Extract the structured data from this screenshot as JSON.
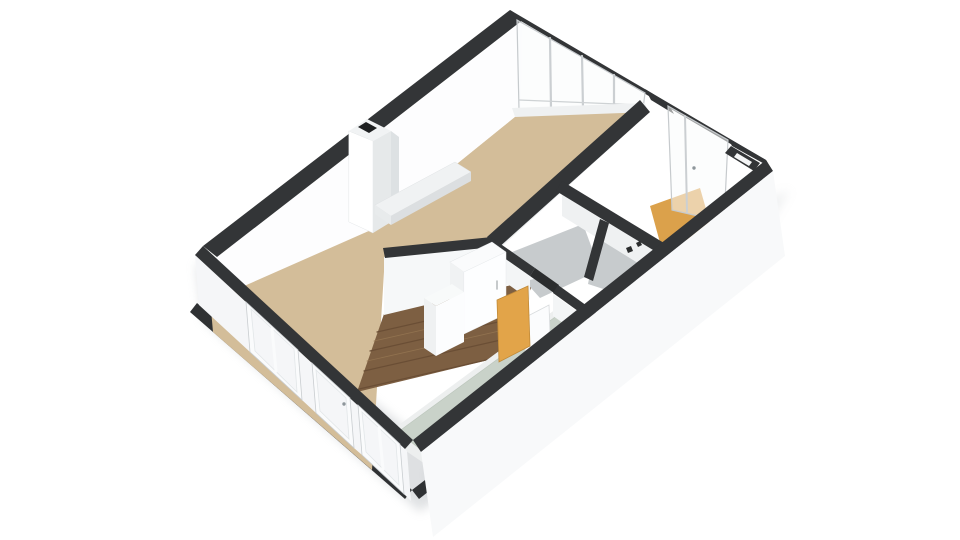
{
  "canvas": {
    "width": 960,
    "height": 540,
    "background": "#ffffff"
  },
  "palette": {
    "wall_top_dark": "#333537",
    "wall_face_white": "#fdfdfe",
    "floor_living_tan": "#d3bd99",
    "floor_hall_wood": "#7d5f42",
    "floor_bath_sage": "#c9d2c9",
    "floor_storage_gray": "#c7cbcd",
    "floor_balcony_orange": "#dba14b",
    "door_orange": "#e2a449",
    "frame_gray": "#c9cdd0",
    "slab_edge_dark": "#2f3133"
  },
  "scene": {
    "shapes": [
      {
        "name": "ground-shadow-sw",
        "type": "polygon",
        "points": "196,262 203,320 420,512 478,466 435,450",
        "fill": "#aab0b5",
        "opacity": 0.38,
        "blur": true
      },
      {
        "name": "ground-shadow-se",
        "type": "polygon",
        "points": "430,500 760,240 790,190 740,210 425,470",
        "fill": "#b6bbbf",
        "opacity": 0.22,
        "blur": true
      },
      {
        "name": "floor-slab-edge-sw",
        "type": "polygon",
        "points": "197,303 412,490 405,499 190,312",
        "fill": "#2f3133"
      },
      {
        "name": "floor-slab-edge-corner",
        "type": "polygon",
        "points": "412,490 468,447 475,455 419,499",
        "fill": "#2f3133"
      },
      {
        "name": "living-room-floor",
        "type": "polygon",
        "points": "210,298 380,226 521,112 640,112 488,246 385,255 372,470 213,332",
        "fill": "#d3bd99"
      },
      {
        "name": "hallway-wood-floor",
        "type": "polygon",
        "points": "357,392 384,314 534,280 505,356",
        "fill": "#7d5f42"
      },
      {
        "name": "wood-plank-line-1",
        "type": "line",
        "x1": 377,
        "y1": 332,
        "x2": 527,
        "y2": 298,
        "stroke": "#6a4e35",
        "stroke_width": 1.2
      },
      {
        "name": "wood-plank-line-2",
        "type": "line",
        "x1": 370,
        "y1": 351,
        "x2": 520,
        "y2": 317,
        "stroke": "#6a4e35",
        "stroke_width": 1.2
      },
      {
        "name": "wood-plank-line-3",
        "type": "line",
        "x1": 364,
        "y1": 371,
        "x2": 514,
        "y2": 337,
        "stroke": "#6a4e35",
        "stroke_width": 1.2
      },
      {
        "name": "wood-plank-line-4",
        "type": "line",
        "x1": 359,
        "y1": 389,
        "x2": 508,
        "y2": 355,
        "stroke": "#6a4e35",
        "stroke_width": 1.2
      },
      {
        "name": "wood-plank-highlight-1",
        "type": "line",
        "x1": 374,
        "y1": 341,
        "x2": 524,
        "y2": 307,
        "stroke": "#91724f",
        "stroke_width": 0.8
      },
      {
        "name": "wood-plank-highlight-2",
        "type": "line",
        "x1": 367,
        "y1": 361,
        "x2": 517,
        "y2": 327,
        "stroke": "#91724f",
        "stroke_width": 0.8
      },
      {
        "name": "bathroom-floor-border",
        "type": "polygon",
        "points": "384,436 560,306 604,338 434,470",
        "fill": "#edefef"
      },
      {
        "name": "bathroom-floor-sage",
        "type": "polygon",
        "points": "398,432 558,315 590,338 428,455",
        "fill": "#c9d2c9",
        "stroke": "#bdc7bd",
        "stroke_width": 0.75
      },
      {
        "name": "storage-room-floor-1",
        "type": "polygon",
        "points": "502,256 583,224 600,270 540,298",
        "fill": "#c7cbcd"
      },
      {
        "name": "storage-room-floor-2",
        "type": "polygon",
        "points": "598,232 655,252 637,300 588,284",
        "fill": "#c7cbcd"
      },
      {
        "name": "balcony-room-floor-orange",
        "type": "polygon",
        "points": "650,206 700,188 712,230 662,250",
        "fill": "#dba14b"
      },
      {
        "name": "nw-wall-inner-face",
        "type": "polygon",
        "points": "216,258 522,22 521,112 380,226 226,294",
        "fill": "#fdfdfe"
      },
      {
        "name": "nw-wall-top-band",
        "type": "polygon",
        "points": "203,246 510,10 524,19 217,257",
        "fill": "#333537"
      },
      {
        "name": "chimney-left-face",
        "type": "polygon",
        "points": "349,131 373,141 373,233 349,222",
        "fill": "#ffffff",
        "stroke": "#e4e7e9",
        "stroke_width": 0.5
      },
      {
        "name": "chimney-right-face",
        "type": "polygon",
        "points": "373,141 391,131 391,222 373,233",
        "fill": "#e6e9ea"
      },
      {
        "name": "chimney-flue-facet",
        "type": "polygon",
        "points": "391,131 399,137 399,214 391,222",
        "fill": "#dde1e3"
      },
      {
        "name": "chimney-top-face",
        "type": "polygon",
        "points": "349,131 367,119 391,131 373,141",
        "fill": "#f1f3f4"
      },
      {
        "name": "chimney-flue-slot",
        "type": "polygon",
        "points": "358,127 366,122 377,128 369,133",
        "fill": "#1e2021"
      },
      {
        "name": "hearth-top",
        "type": "polygon",
        "points": "375,205 455,162 471,172 391,216",
        "fill": "#f0f2f3",
        "stroke": "#dfe2e4",
        "stroke_width": 0.5
      },
      {
        "name": "hearth-front-face",
        "type": "polygon",
        "points": "391,216 471,172 471,181 391,225",
        "fill": "#dcdfe1"
      },
      {
        "name": "hearth-side-face",
        "type": "polygon",
        "points": "375,205 391,216 391,225 375,214",
        "fill": "#e8ebec"
      },
      {
        "name": "ne-wall-top-band",
        "type": "polygon",
        "points": "510,10 766,160 770,167 514,17",
        "fill": "#333537"
      },
      {
        "name": "ne-window-glass",
        "type": "polygon",
        "points": "517,20 645,93 643,109 519,110",
        "fill": "rgba(250,251,252,0.5)",
        "stroke": "#c6cacd",
        "stroke_width": 1.2
      },
      {
        "name": "ne-window-mullion-1",
        "type": "line",
        "x1": 550,
        "y1": 38,
        "x2": 551,
        "y2": 109,
        "stroke": "#cbcfd2",
        "stroke_width": 2.2
      },
      {
        "name": "ne-window-mullion-2",
        "type": "line",
        "x1": 582,
        "y1": 56,
        "x2": 583,
        "y2": 109,
        "stroke": "#cbcfd2",
        "stroke_width": 2.2
      },
      {
        "name": "ne-window-mullion-3",
        "type": "line",
        "x1": 614,
        "y1": 75,
        "x2": 614,
        "y2": 108,
        "stroke": "#cbcfd2",
        "stroke_width": 2.2
      },
      {
        "name": "ne-window-transom",
        "type": "line",
        "x1": 519,
        "y1": 100,
        "x2": 643,
        "y2": 105,
        "stroke": "#ced2d4",
        "stroke_width": 1.2
      },
      {
        "name": "ne-window-sill",
        "type": "polygon",
        "points": "512,108 645,103 648,112 515,117",
        "fill": "#eff1f2"
      },
      {
        "name": "ne-wall-pier-band",
        "type": "polygon",
        "points": "645,89 668,103 674,114 651,100",
        "fill": "#333537"
      },
      {
        "name": "balcony-door-glass",
        "type": "polygon",
        "points": "668,106 728,140 724,222 672,210",
        "fill": "rgba(250,251,252,0.55)",
        "stroke": "#c6cacd",
        "stroke_width": 1.2
      },
      {
        "name": "balcony-door-divider",
        "type": "line",
        "x1": 685,
        "y1": 116,
        "x2": 687,
        "y2": 212,
        "stroke": "#cbcfd2",
        "stroke_width": 2
      },
      {
        "name": "balcony-door-handle",
        "type": "circle",
        "cx": 694,
        "cy": 168,
        "r": 1.7,
        "fill": "#8e969b"
      },
      {
        "name": "ne-wall-right-band",
        "type": "polygon",
        "points": "728,138 766,160 770,167 732,146",
        "fill": "#333537"
      },
      {
        "name": "corner-pillar-dark",
        "type": "polygon",
        "points": "731,146 760,163 754,171 725,153",
        "fill": "#333537"
      },
      {
        "name": "corner-pillar-notch",
        "type": "polygon",
        "points": "737,153 752,162 749,166 734,157",
        "fill": "#f4f5f6"
      },
      {
        "name": "wall-b-face",
        "type": "polygon",
        "points": "490,244 643,107 643,118 496,252",
        "fill": "#eef0f1"
      },
      {
        "name": "wall-b-top-band",
        "type": "polygon",
        "points": "640,100 650,112 497,249 487,237",
        "fill": "#333537"
      },
      {
        "name": "wall-e-face",
        "type": "polygon",
        "points": "562,190 662,252 662,278 562,216",
        "fill": "#eff1f2"
      },
      {
        "name": "wall-e-top-band",
        "type": "polygon",
        "points": "562,181 664,243 658,253 556,191",
        "fill": "#333537"
      },
      {
        "name": "wall-f-top-band",
        "type": "polygon",
        "points": "600,219 609,223 593,281 584,277",
        "fill": "#333537"
      },
      {
        "name": "wall-a-face",
        "type": "polygon",
        "points": "384,257 493,246 534,279 384,315",
        "fill": "#f6f8f9"
      },
      {
        "name": "wall-a-top-band",
        "type": "polygon",
        "points": "383,248 492,237 494,247 385,258",
        "fill": "#333537"
      },
      {
        "name": "wall-c-face-1",
        "type": "polygon",
        "points": "488,247 530,277 530,300 488,270",
        "fill": "#f3f5f6"
      },
      {
        "name": "wall-c-top-band-1",
        "type": "polygon",
        "points": "492,238 535,268 530,276 487,246",
        "fill": "#333537"
      },
      {
        "name": "door-threshold",
        "type": "polygon",
        "points": "535,268 559,285 554,293 530,276",
        "fill": "#2b2d2e"
      },
      {
        "name": "wall-c-face-2",
        "type": "polygon",
        "points": "553,294 596,325 596,346 553,316",
        "fill": "#f3f5f6"
      },
      {
        "name": "wall-c-top-band-2",
        "type": "polygon",
        "points": "558,285 601,316 596,324 553,293",
        "fill": "#333537"
      },
      {
        "name": "hinge-mark-1",
        "type": "polygon",
        "points": "626,248 631,246 633,251 628,253",
        "fill": "#2b2d2e"
      },
      {
        "name": "hinge-mark-2",
        "type": "polygon",
        "points": "636,243 640,241 642,245 638,247",
        "fill": "#2b2d2e"
      },
      {
        "name": "closet-top",
        "type": "polygon",
        "points": "450,262 492,242 506,252 464,272",
        "fill": "#fafbfc",
        "stroke": "#e2e5e7",
        "stroke_width": 0.5
      },
      {
        "name": "closet-left-face",
        "type": "polygon",
        "points": "450,262 464,272 464,334 450,322",
        "fill": "#f0f2f3"
      },
      {
        "name": "closet-front-face",
        "type": "polygon",
        "points": "464,272 506,252 506,314 464,334",
        "fill": "#fdfeff",
        "stroke": "#e8ebed",
        "stroke_width": 0.5
      },
      {
        "name": "closet-handle",
        "type": "line",
        "x1": 497,
        "y1": 281,
        "x2": 497,
        "y2": 289,
        "stroke": "#b3b8bb",
        "stroke_width": 1.5
      },
      {
        "name": "cabinet-top",
        "type": "polygon",
        "points": "424,298 452,284 464,292 436,306",
        "fill": "#f8fafa"
      },
      {
        "name": "cabinet-left-face",
        "type": "polygon",
        "points": "424,298 436,306 436,356 424,348",
        "fill": "#eff1f2"
      },
      {
        "name": "cabinet-front-face",
        "type": "polygon",
        "points": "436,306 464,292 464,342 436,356",
        "fill": "#fcfdfe"
      },
      {
        "name": "open-door-white",
        "type": "polygon",
        "points": "524,318 549,305 551,362 526,376",
        "fill": "#fbfcfd",
        "stroke": "#d8dbdd",
        "stroke_width": 0.8
      },
      {
        "name": "open-door-orange",
        "type": "polygon",
        "points": "497,300 528,286 530,346 499,362",
        "fill": "#e2a449",
        "stroke": "#c08a38",
        "stroke_width": 0.8
      },
      {
        "name": "sw-wall-pier-0",
        "type": "polygon",
        "points": "195,255 246,302 250,352 199,305",
        "fill": "#f5f6f8"
      },
      {
        "name": "sw-wall-pier-1",
        "type": "polygon",
        "points": "298,350 312,363 316,413 302,400",
        "fill": "#f5f6f8"
      },
      {
        "name": "sw-wall-pier-2",
        "type": "polygon",
        "points": "350,398 358,405 362,455 354,448",
        "fill": "#f5f6f8"
      },
      {
        "name": "sw-wall-pier-3",
        "type": "polygon",
        "points": "400,444 407,451 411,501 404,494",
        "fill": "#f5f6f8"
      },
      {
        "name": "sw-wall-top-band",
        "type": "polygon",
        "points": "203,246 413,440 405,449 195,255",
        "fill": "#333537"
      },
      {
        "name": "sw-window-1-frame",
        "type": "polygon",
        "points": "246,302 298,350 302,400 250,352",
        "fill": "#fafbfc",
        "stroke": "#c9cdd0",
        "stroke_width": 0.8
      },
      {
        "name": "sw-window-1-glass",
        "type": "polygon",
        "points": "251,309 294,349 297,392 255,351",
        "fill": "rgba(234,239,242,0.35)",
        "stroke": "#e2e6e8",
        "stroke_width": 0.8
      },
      {
        "name": "sw-window-1-mullion",
        "type": "line",
        "x1": 272,
        "y1": 329,
        "x2": 276,
        "y2": 371,
        "stroke": "#fafbfc",
        "stroke_width": 3
      },
      {
        "name": "sw-door-frame",
        "type": "polygon",
        "points": "312,363 350,398 354,448 316,413",
        "fill": "#fafbfc",
        "stroke": "#c9cdd0",
        "stroke_width": 0.8
      },
      {
        "name": "sw-door-glass",
        "type": "polygon",
        "points": "316,370 346,398 349,439 320,411",
        "fill": "rgba(234,239,242,0.35)",
        "stroke": "#e2e6e8",
        "stroke_width": 0.8
      },
      {
        "name": "sw-door-handle",
        "type": "circle",
        "cx": 344,
        "cy": 404,
        "r": 1.7,
        "fill": "#8e969b"
      },
      {
        "name": "sw-window-2-frame",
        "type": "polygon",
        "points": "358,405 400,444 404,494 362,455",
        "fill": "#fafbfc",
        "stroke": "#c9cdd0",
        "stroke_width": 0.8
      },
      {
        "name": "sw-window-2-glass",
        "type": "polygon",
        "points": "362,412 396,444 399,485 366,452",
        "fill": "rgba(234,239,242,0.35)",
        "stroke": "#e2e6e8",
        "stroke_width": 0.8
      },
      {
        "name": "sw-window-2-mullion",
        "type": "line",
        "x1": 379,
        "y1": 428,
        "x2": 383,
        "y2": 469,
        "stroke": "#fafbfc",
        "stroke_width": 3
      },
      {
        "name": "se-wall-top-band",
        "type": "polygon",
        "points": "766,160 413,440 421,452 773,171",
        "fill": "#333537"
      },
      {
        "name": "se-wall-exterior-face",
        "type": "polygon",
        "points": "773,171 421,452 433,537 785,256",
        "fill": "#f8f9fa"
      }
    ]
  }
}
